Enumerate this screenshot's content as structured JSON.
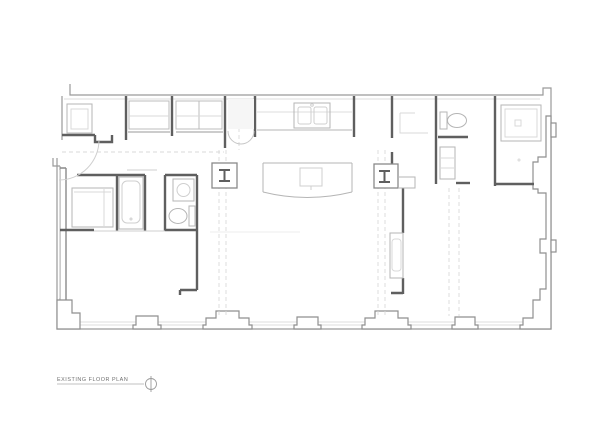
{
  "title_block": {
    "label": "EXISTING FLOOR PLAN",
    "marker": "crosshair-circle-symbol"
  },
  "palette": {
    "partition_wall": "#5f5f5f",
    "exterior_wall": "#9a9a9a",
    "fixture_line": "#b5b5b5",
    "faint_line": "#d9d9d9",
    "text": "#6e6e6e",
    "background": "#ffffff"
  },
  "plan_elements": {
    "entry": "double-entry-door",
    "top_band": [
      "utility-room",
      "closet",
      "closet",
      "kitchen-counter-with-double-sink",
      "den",
      "toilet-room",
      "shower-room"
    ],
    "middle": [
      "kitchen-island-with-cooktop",
      "steel-column-left",
      "steel-column-right",
      "overhead-beam-dashed-lines"
    ],
    "left_suite": [
      "wardrobe",
      "bathtub",
      "bathroom-sink",
      "toilet",
      "bedroom"
    ],
    "perimeter": [
      "window-pilasters-bottom-wall",
      "window-pilasters-right-wall"
    ]
  }
}
